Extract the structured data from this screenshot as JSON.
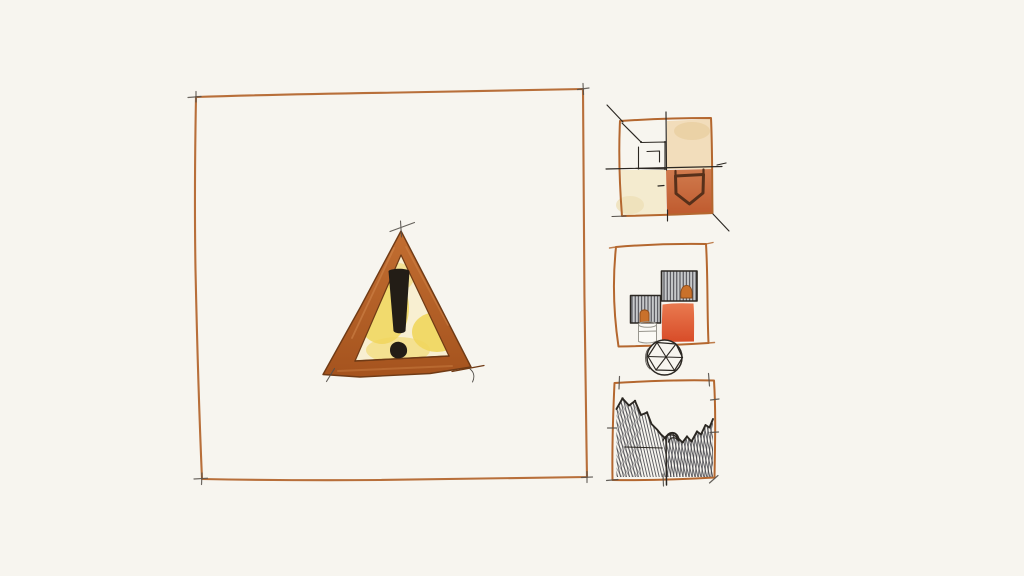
{
  "scene": {
    "label": "Hand-drawn ink and watercolor sketch of a warning sign with three study thumbnails",
    "panels": {
      "main": "Large framed panel with watercolor warning triangle and exclamation mark",
      "thumb1": "Quadrant study: peach and cream washes, squared spiral, terracotta block with shield outline",
      "thumb2": "Block study: two hatched squares with orange accents, red-orange block, cylinder, faceted sphere",
      "thumb3": "Terrain study: jagged ridge line with dense hatched valley fill"
    }
  },
  "icons": {
    "warning": "warning-triangle-icon",
    "exclamation": "exclamation-mark",
    "shield": "shield-outline-icon",
    "spiral": "spiral-square-icon",
    "sphere": "geodesic-sphere-icon"
  },
  "colors": {
    "paper": "#f7f5ef",
    "frame_orange": "#b4672f",
    "ink_black": "#2b2722",
    "graphite": "#55504a",
    "band_top": "#c26e31",
    "band_bottom": "#a5531e",
    "band_edge": "#6f3a15",
    "tri_fill": "#f8efd1",
    "tri_yellow": "#f0d65c",
    "excl": "#231d16",
    "wash_peach": "#f2ddbb",
    "peach_deep": "#ead0a4",
    "wash_cream": "#f4ebcf",
    "cream_deep": "#eee0b6",
    "terra_top": "#d07b4e",
    "terra_bottom": "#bf5a2e",
    "red_top": "#e97a50",
    "red_bottom": "#d84c28",
    "blob_orange": "#c9712b",
    "blob_edge": "#8d4d1c",
    "hatch_bg": "#c7c9cb",
    "hatch_line": "#3a3a40",
    "shield_dark": "#57301a",
    "cyl_gray": "#98968e"
  }
}
